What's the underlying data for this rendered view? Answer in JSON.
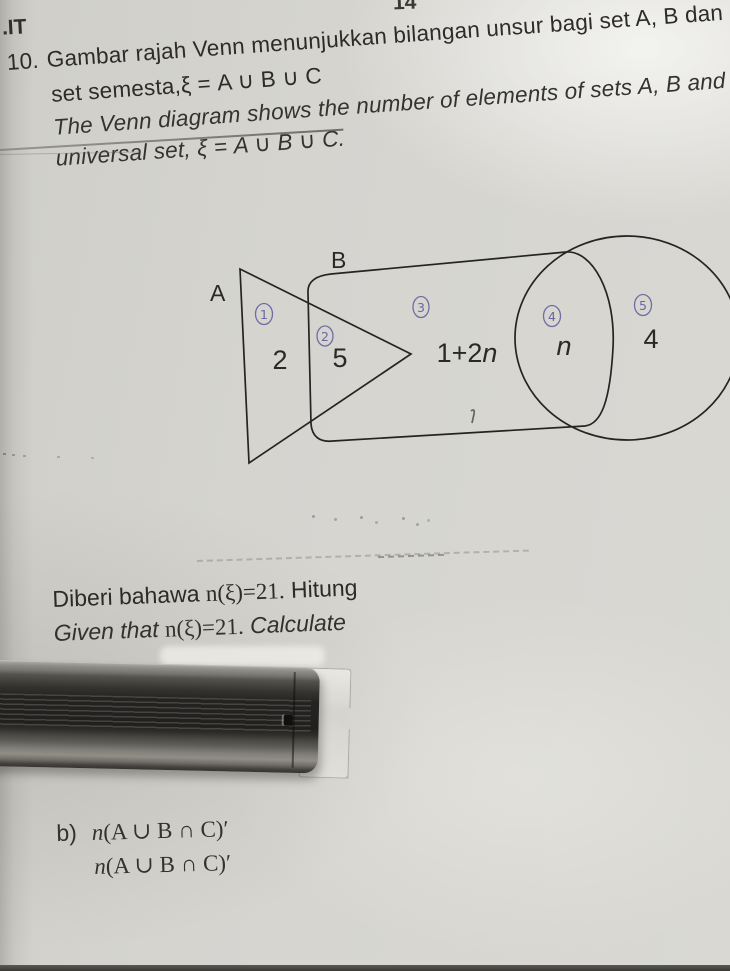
{
  "page": {
    "corner_label": ".IT",
    "page_number": "14"
  },
  "question": {
    "number": "10.",
    "malay_line1": "Gambar rajah Venn menunjukkan bilangan unsur bagi set A, B dan",
    "malay_line2": "set semesta,ξ = A ∪ B ∪ C",
    "english_line1": "The Venn diagram shows the number of elements of sets A, B and",
    "english_line2": "universal set, ξ = A ∪ B ∪ C."
  },
  "venn": {
    "label_a": "A",
    "label_b": "B",
    "region_values": {
      "a_only": "2",
      "a_and_b": "5",
      "b_only_prefix": "1+2",
      "b_only_var": "n",
      "b_and_c": "n",
      "c_only": "4"
    },
    "marks": [
      "1",
      "2",
      "3",
      "4",
      "5"
    ]
  },
  "given": {
    "malay_prefix": "Diberi bahawa",
    "math": "n(ξ)=21.",
    "malay_suffix": "Hitung",
    "english_prefix": "Given that",
    "english_suffix": "Calculate"
  },
  "part_b": {
    "label": "b)",
    "var": "n",
    "expression": "(A ∪ B ∩ C)′"
  }
}
